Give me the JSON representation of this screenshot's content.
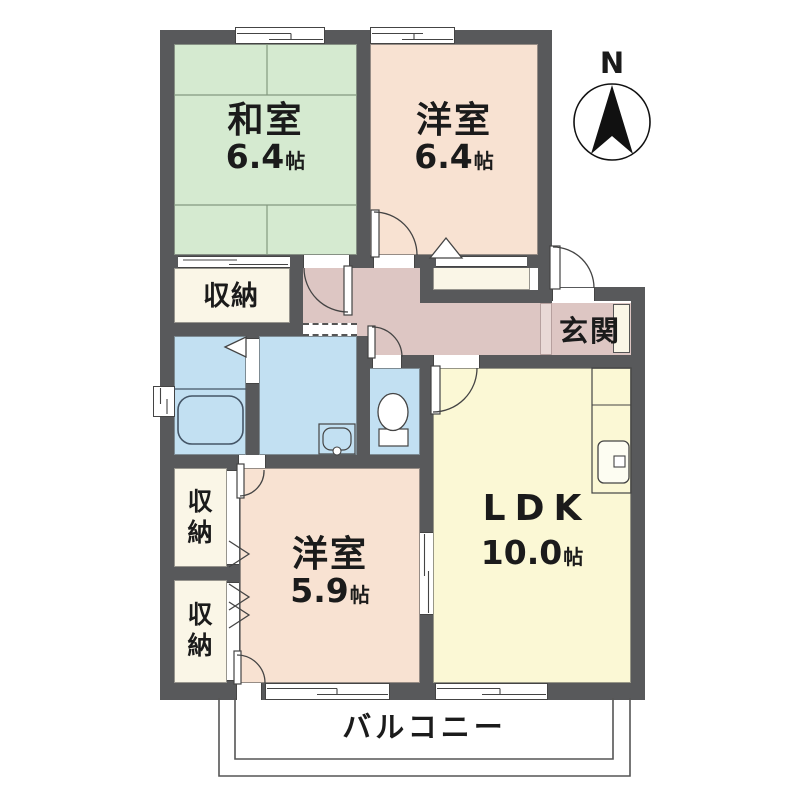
{
  "compass": {
    "label": "N"
  },
  "rooms": {
    "washitsu": {
      "name": "和室",
      "size": "6.4",
      "unit": "帖"
    },
    "youshitsu_upper": {
      "name": "洋室",
      "size": "6.4",
      "unit": "帖"
    },
    "youshitsu_lower": {
      "name": "洋室",
      "size": "5.9",
      "unit": "帖"
    },
    "ldk": {
      "name": "LDK",
      "size": "10.0",
      "unit": "帖"
    },
    "genkan": {
      "name": "玄関"
    },
    "closet_upper": {
      "name": "収納"
    },
    "closet_mid": {
      "name": "収納"
    },
    "closet_lower": {
      "name": "収納"
    },
    "balcony": {
      "name": "バルコニー"
    }
  },
  "colors": {
    "wall": "#58595b",
    "tatami_green": "#d5ead0",
    "bedroom_peach": "#f8e2d2",
    "ldk_yellow": "#fbf8d5",
    "hall_mauve": "#ddc6c3",
    "wet_area_blue": "#c2e0f2",
    "closet_cream": "#faf6e7"
  }
}
